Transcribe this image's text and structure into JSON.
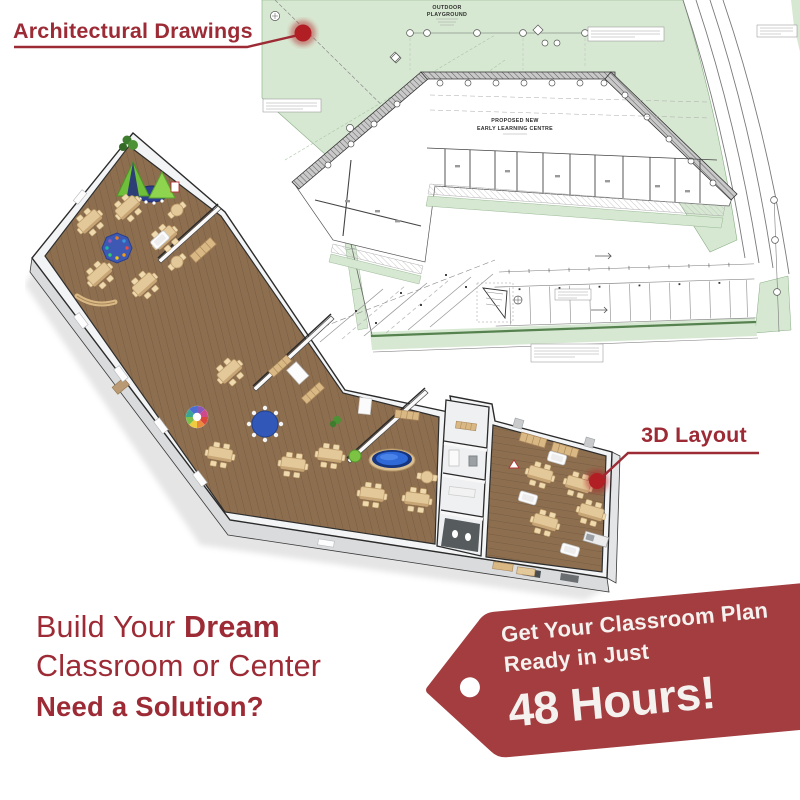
{
  "callouts": {
    "architectural": {
      "label": "Architectural Drawings"
    },
    "layout_3d": {
      "label": "3D Layout"
    }
  },
  "headline": {
    "line1_prefix": "Build Your ",
    "line1_emphasis": "Dream",
    "line2": "Classroom or Center",
    "line3": "Need a Solution?"
  },
  "offer_tag": {
    "line1": "Get Your Classroom Plan",
    "line2": "Ready in Just",
    "highlight": "48 Hours!"
  },
  "floor_plan": {
    "playground_line1": "OUTDOOR",
    "playground_line2": "PLAYGROUND",
    "building_line1": "PROPOSED NEW",
    "building_line2": "EARLY LEARNING CENTRE"
  },
  "colors": {
    "maroon": "#9d2b35",
    "tag_red": "#a33d3f",
    "dot_red": "#b11f24",
    "plan_green": "#d7e8d2",
    "plan_green_line": "#7fa87c",
    "wood_floor": "#8d6f50",
    "wood_furniture": "#e3c899"
  }
}
